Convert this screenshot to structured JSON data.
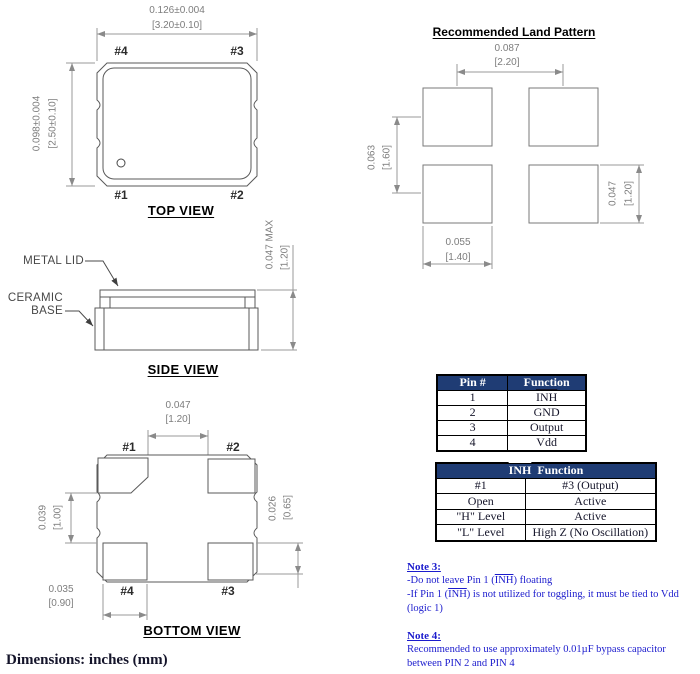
{
  "colors": {
    "table_header_bg": "#1F3C74",
    "note_text": "#1B1BCD",
    "dimension_text": "#7D7D7D",
    "outline": "#5A5A5A"
  },
  "top_view": {
    "title": "TOP VIEW",
    "dim_w_in": "0.126±0.004",
    "dim_w_mm": "[3.20±0.10]",
    "dim_h_in": "0.098±0.004",
    "dim_h_mm": "[2.50±0.10]",
    "pin_tl": "#4",
    "pin_tr": "#3",
    "pin_bl": "#1",
    "pin_br": "#2"
  },
  "land_pattern": {
    "title": "Recommended Land Pattern",
    "pitch_h_in": "0.087",
    "pitch_h_mm": "[2.20]",
    "pitch_v_in": "0.063",
    "pitch_v_mm": "[1.60]",
    "pad_h_in": "0.047",
    "pad_h_mm": "[1.20]",
    "pad_w_in": "0.055",
    "pad_w_mm": "[1.40]"
  },
  "side_view": {
    "title": "SIDE VIEW",
    "label_metal_lid": "METAL LID",
    "label_ceramic": "CERAMIC",
    "label_base": "BASE",
    "dim_in": "0.047  MAX",
    "dim_mm": "[1.20]"
  },
  "bottom_view": {
    "title": "BOTTOM VIEW",
    "dim_top_in": "0.047",
    "dim_top_mm": "[1.20]",
    "dim_left_in": "0.039",
    "dim_left_mm": "[1.00]",
    "dim_right_in": "0.026",
    "dim_right_mm": "[0.65]",
    "dim_bot_in": "0.035",
    "dim_bot_mm": "[0.90]",
    "pin_tl": "#1",
    "pin_tr": "#2",
    "pin_bl": "#4",
    "pin_br": "#3"
  },
  "pin_table": {
    "header_pin": "Pin #",
    "header_function": "Function",
    "rows": [
      {
        "pin": "1",
        "func": "INH"
      },
      {
        "pin": "2",
        "func": "GND"
      },
      {
        "pin": "3",
        "func": "Output"
      },
      {
        "pin": "4",
        "func": "Vdd"
      }
    ]
  },
  "inh_table": {
    "header_inh": "INH",
    "header_rest": "  Function",
    "rows": [
      {
        "c1": "#1",
        "c2": "#3 (Output)"
      },
      {
        "c1": "Open",
        "c2": "Active"
      },
      {
        "c1": "\"H\" Level",
        "c2": "Active"
      },
      {
        "c1": "\"L\" Level",
        "c2": "High Z (No Oscillation)"
      }
    ]
  },
  "notes": {
    "inh": "INH",
    "note3_title": "Note 3:",
    "n3_l1_pre": "-Do not leave Pin 1 (",
    "n3_l1_post": ") floating",
    "n3_l2_pre": "-If Pin 1 (",
    "n3_l2_post": ") is not utilized for toggling, it must be tied to Vdd",
    "n3_l3": "(logic 1)",
    "note4_title": "Note 4:",
    "n4_l1": "Recommended to use approximately 0.01µF bypass capacitor",
    "n4_l2": "between PIN 2 and PIN 4"
  },
  "footer": {
    "dimensions_note": "Dimensions: inches (mm)"
  }
}
